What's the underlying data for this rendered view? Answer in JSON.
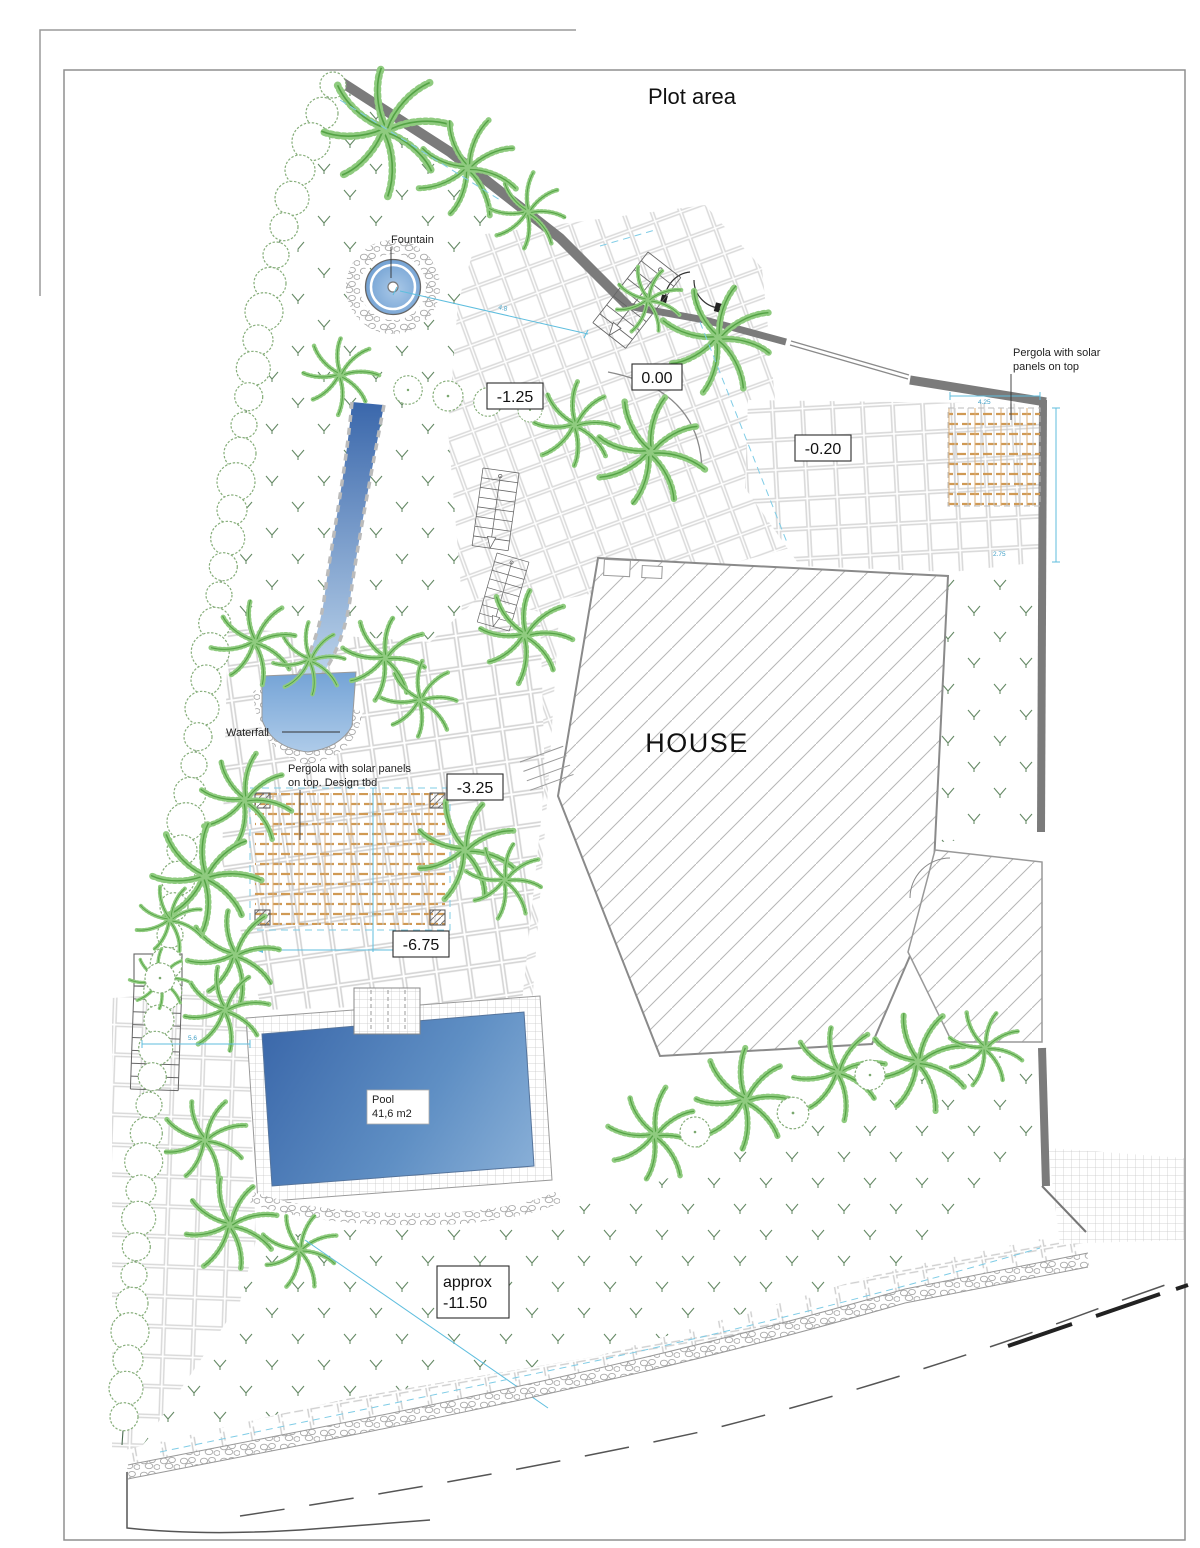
{
  "title": "Plot area",
  "labels": {
    "house": "HOUSE",
    "fountain": "Fountain",
    "waterfall": "Waterfall",
    "pool_name": "Pool",
    "pool_area": "41,6 m2",
    "pergola_garden_1": "Pergola with solar panels",
    "pergola_garden_2": "on top. Design tbd",
    "pergola_entry_1": "Pergola with solar",
    "pergola_entry_2": "panels on top"
  },
  "levels": {
    "entrance": "0.00",
    "upper_terrace": "-1.25",
    "entry_court": "-0.20",
    "mid_terrace": "-3.25",
    "pergola_terrace": "-6.75",
    "lower_garden_1": "approx",
    "lower_garden_2": "-11.50"
  },
  "dimensions": {
    "d1": "4.8",
    "d2": "4.25",
    "d3": "2.75",
    "d4": "5.6"
  },
  "colors": {
    "wall": "#7b7b7b",
    "water_dark": "#3b68aa",
    "water_light": "#aecbe9",
    "palm_green": "#7cc06d",
    "hedge_green": "#85ad79",
    "pergola_beam": "#d09a55",
    "dimension_blue": "#5fbede",
    "tile_line": "#d8d8d8"
  }
}
